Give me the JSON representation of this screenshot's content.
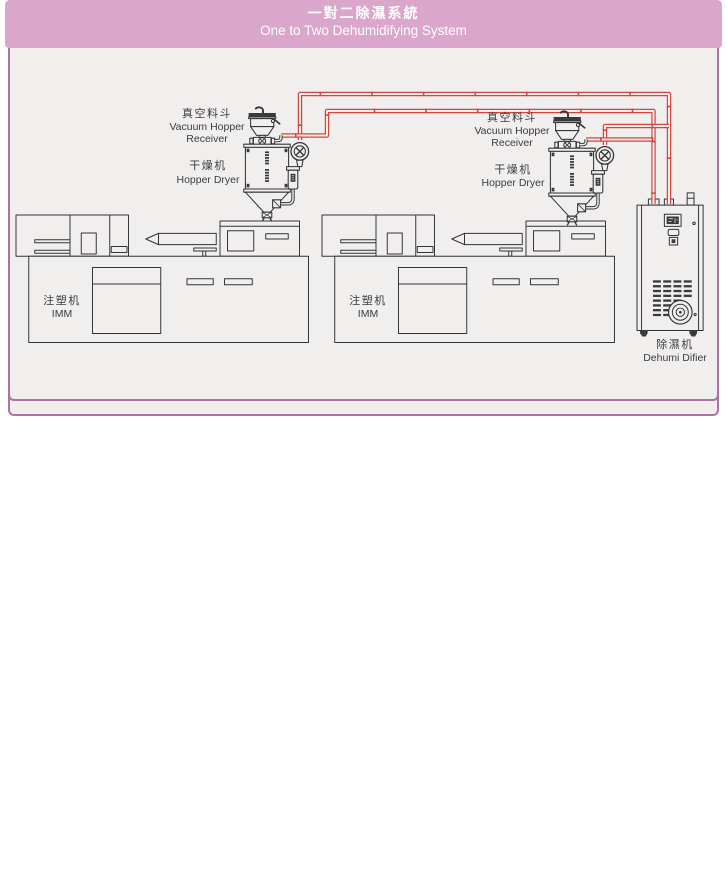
{
  "colors": {
    "header_bg": "#dba6cc",
    "panel_border": "#ab72a2",
    "panel_bg": "#f1eeee",
    "line": "#333333",
    "pipe_red": "#d4463d",
    "label_text": "#3c3c3c",
    "header_text": "#ffffff"
  },
  "panels": [
    {
      "header": {
        "title_zh": "一對一除濕系統",
        "title_en": "One to One Dehumidifying System"
      },
      "labels": {
        "vacuum_hopper": {
          "zh": "真空料斗",
          "en_line1": "Vacuum Hopper",
          "en_line2": "Receiver"
        },
        "hopper_dryer": {
          "zh": "干燥机",
          "en": "Hopper Dryer"
        },
        "imm": {
          "zh": "注塑机",
          "en": "IMM"
        },
        "dehumidifier": {
          "zh": "除濕机",
          "en": "Dehumi Difier"
        }
      }
    },
    {
      "header": {
        "title_zh": "一對二除濕系統",
        "title_en": "One to Two Dehumidifying System"
      },
      "labels": {
        "vacuum_hopper_left": {
          "zh": "真空料斗",
          "en_line1": "Vacuum Hopper",
          "en_line2": "Receiver"
        },
        "hopper_dryer_left": {
          "zh": "干燥机",
          "en": "Hopper Dryer"
        },
        "vacuum_hopper_right": {
          "zh": "真空料斗",
          "en_line1": "Vacuum Hopper",
          "en_line2": "Receiver"
        },
        "hopper_dryer_right": {
          "zh": "干燥机",
          "en": "Hopper Dryer"
        },
        "imm_left": {
          "zh": "注塑机",
          "en": "IMM"
        },
        "imm_right": {
          "zh": "注塑机",
          "en": "IMM"
        },
        "dehumidifier": {
          "zh": "除濕机",
          "en": "Dehumi Difier"
        }
      }
    }
  ]
}
